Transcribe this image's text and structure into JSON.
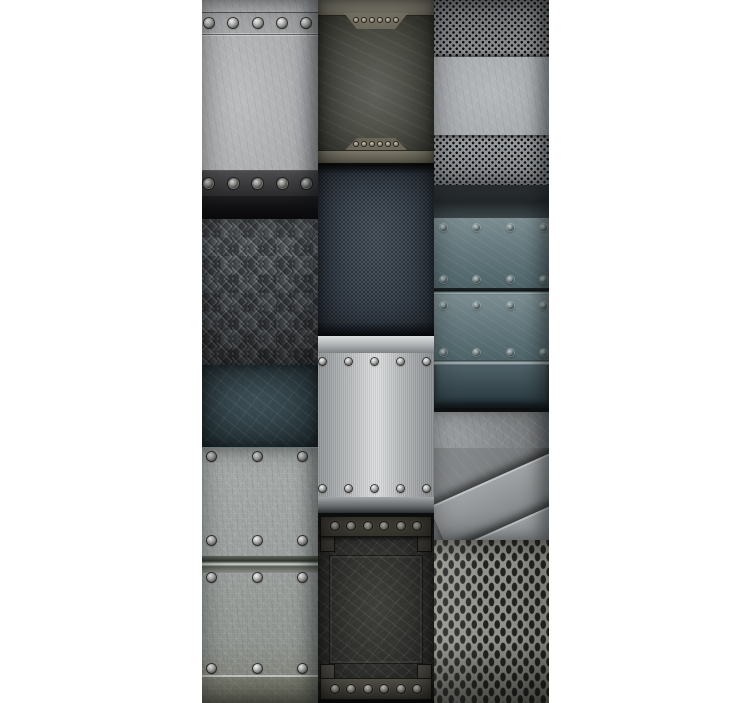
{
  "page": {
    "background_color": "#ffffff",
    "width": 752,
    "height": 703
  },
  "collage": {
    "left": 202,
    "top": 0,
    "width": 347,
    "height": 703,
    "description": "Collage of twelve metal texture photographs in three vertical columns on a white background",
    "columns": [
      {
        "name": "left",
        "tiles": [
          {
            "label": "Riveted gray metal plaque",
            "texture": "scratched-steel",
            "height": 219,
            "base_color": "#a8a9ab",
            "rivet_rows_y": [
              23,
              183
            ],
            "rivets_per_row": 5
          },
          {
            "label": "Dark diamond checker plate",
            "texture": "checker-plate",
            "height": 146,
            "base_color": "#45484b"
          },
          {
            "label": "Dark teal grunge plate",
            "texture": "grunge-teal",
            "height": 82,
            "base_color": "#2f4046"
          },
          {
            "label": "Light riveted metal planks",
            "texture": "riveted-planks",
            "height": 256,
            "base_color": "#9ca19f",
            "rivet_rows_y": [
              455,
              540,
              577,
              668
            ],
            "rivets_per_row": 3
          }
        ]
      },
      {
        "name": "middle",
        "tiles": [
          {
            "label": "Grunge plate with trapezoid brackets",
            "texture": "grunge-olive",
            "height": 166,
            "base_color": "#3a3b33",
            "accent_color": "#938f80",
            "bracket_rivets": 6
          },
          {
            "label": "Navy perforated grunge sheet",
            "texture": "perforated-dark",
            "height": 170,
            "base_color": "#39424d"
          },
          {
            "label": "Bright brushed riveted plaque",
            "texture": "brushed-silver",
            "height": 180,
            "base_color": "#d7d9db",
            "rivet_rows_y": [
              362,
              490
            ],
            "rivets_per_row": 5
          },
          {
            "label": "Dark plaque with bolted bars",
            "texture": "grunge-charcoal",
            "height": 187,
            "base_color": "#2c2c2a",
            "bolt_rows_y": [
              526,
              690
            ],
            "bolts_per_row": 6
          }
        ]
      },
      {
        "name": "right",
        "tiles": [
          {
            "label": "Metal plate on perforated sheet",
            "texture": "perforated-light",
            "height": 185,
            "base_color": "#9b9ea1"
          },
          {
            "label": "Teal riveted metal planks",
            "texture": "riveted-teal-planks",
            "height": 223,
            "base_color": "#65797e",
            "rivet_rows_y": [
              228,
              280,
              305,
              352
            ],
            "rivets_per_row": 4
          },
          {
            "label": "Angled overlapping steel plates",
            "texture": "angled-plates",
            "height": 132,
            "base_color": "#7d8082"
          },
          {
            "label": "Expanded metal diamond mesh",
            "texture": "expanded-mesh",
            "height": 163,
            "base_color": "#8f908b"
          }
        ]
      }
    ]
  },
  "palette": {
    "white_margin": "#ffffff",
    "steel_light": "#a8abae",
    "steel_mid": "#7d8082",
    "steel_dark": "#2c2c2a",
    "teal_dark": "#2f4046",
    "teal_mid": "#65797e",
    "navy_perforated": "#39424d",
    "silver_bright": "#d7d9db",
    "olive_band": "#938f80",
    "black_band": "#101012"
  }
}
